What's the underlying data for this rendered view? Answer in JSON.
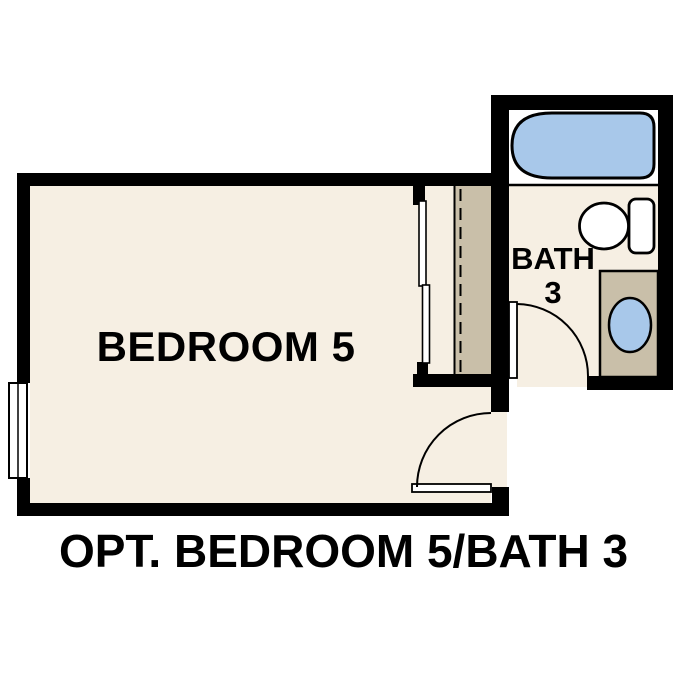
{
  "title": "OPT. BEDROOM 5/BATH 3",
  "rooms": {
    "bedroom": {
      "label": "BEDROOM 5"
    },
    "bath": {
      "label_line1": "BATH",
      "label_line2": "3"
    }
  },
  "fixtures": [
    "bathtub",
    "toilet",
    "vanity-with-sink",
    "closet-shelf-and-rod",
    "sliding-closet-doors",
    "window",
    "swing-door-bedroom",
    "swing-door-bath"
  ],
  "colors": {
    "background": "#ffffff",
    "wall": "#000000",
    "line": "#000000",
    "floor": "#f6efe3",
    "wood": "#c9bfa9",
    "water_blue": "#a8c8ea",
    "fixture_white": "#ffffff",
    "text": "#000000"
  }
}
